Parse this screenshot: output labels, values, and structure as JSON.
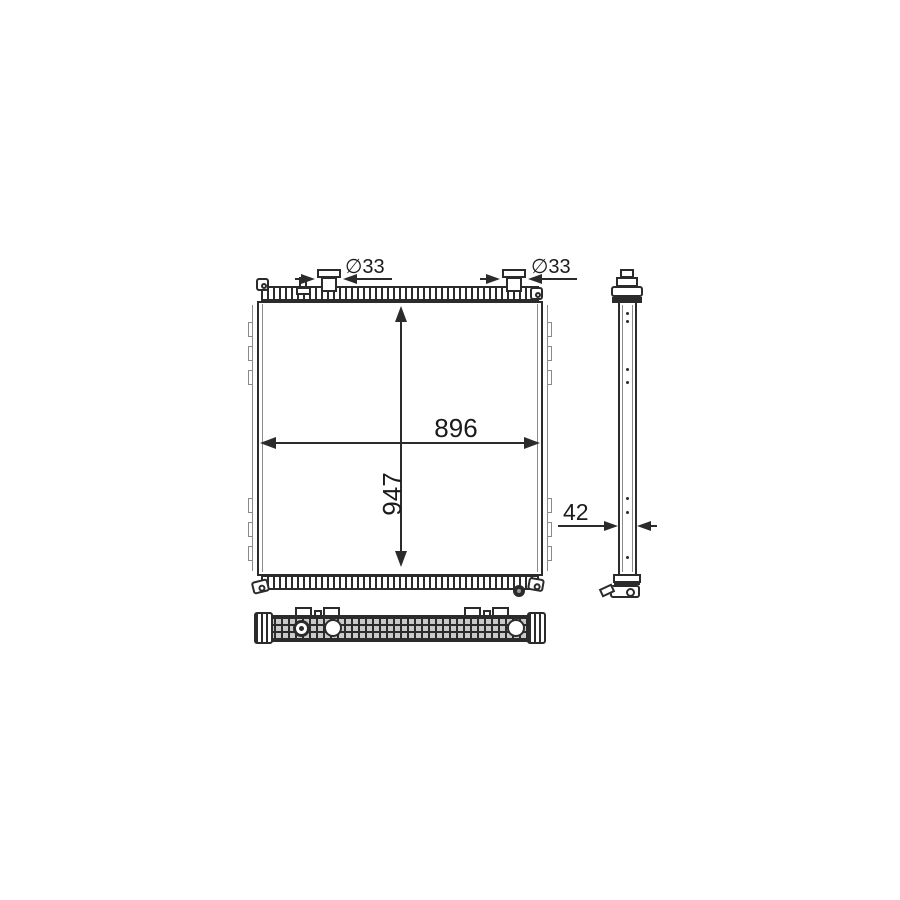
{
  "labels": {
    "core_width": "896",
    "core_height": "947",
    "core_depth": "42",
    "left_pipe_diameter": "∅33",
    "right_pipe_diameter": "∅33"
  },
  "colors": {
    "line": "#2b2b2b",
    "secondary_line": "#8a8a8a",
    "background": "#ffffff"
  }
}
